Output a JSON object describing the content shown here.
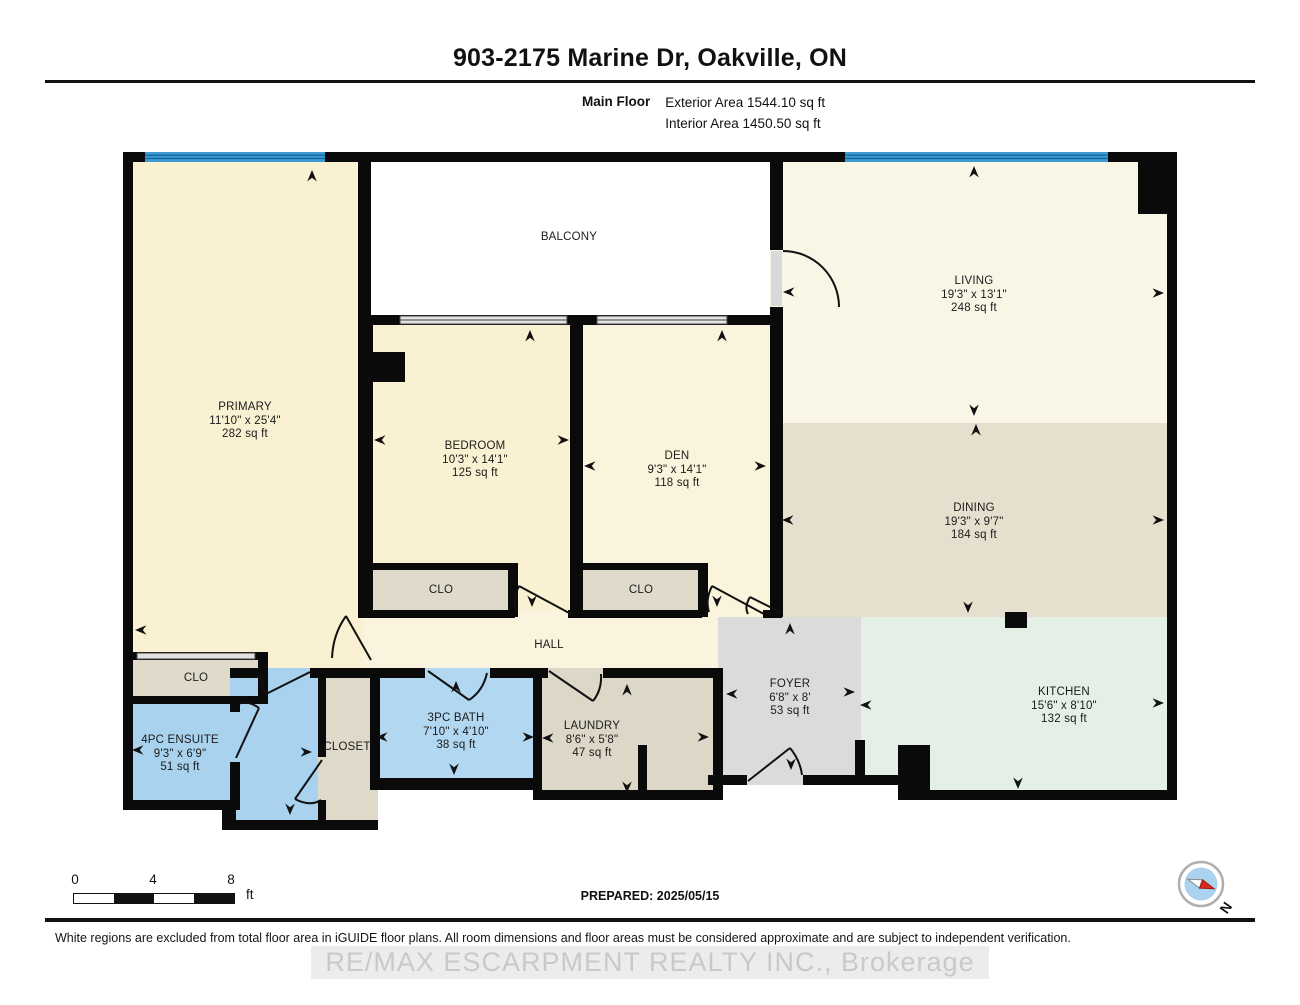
{
  "header": {
    "title": "903-2175 Marine Dr, Oakville, ON",
    "floor_label": "Main Floor",
    "exterior_area": "Exterior Area 1544.10 sq ft",
    "interior_area": "Interior Area 1450.50 sq ft"
  },
  "rooms": {
    "balcony": {
      "name": "BALCONY"
    },
    "primary": {
      "name": "PRIMARY",
      "dims": "11'10\" x 25'4\"",
      "area": "282 sq ft"
    },
    "bedroom": {
      "name": "BEDROOM",
      "dims": "10'3\" x 14'1\"",
      "area": "125 sq ft"
    },
    "den": {
      "name": "DEN",
      "dims": "9'3\" x 14'1\"",
      "area": "118 sq ft"
    },
    "living": {
      "name": "LIVING",
      "dims": "19'3\" x 13'1\"",
      "area": "248 sq ft"
    },
    "dining": {
      "name": "DINING",
      "dims": "19'3\" x 9'7\"",
      "area": "184 sq ft"
    },
    "kitchen": {
      "name": "KITCHEN",
      "dims": "15'6\" x 8'10\"",
      "area": "132 sq ft"
    },
    "foyer": {
      "name": "FOYER",
      "dims": "6'8\" x 8'",
      "area": "53 sq ft"
    },
    "hall": {
      "name": "HALL"
    },
    "laundry": {
      "name": "LAUNDRY",
      "dims": "8'6\" x 5'8\"",
      "area": "47 sq ft"
    },
    "bath": {
      "name": "3PC BATH",
      "dims": "7'10\" x 4'10\"",
      "area": "38 sq ft"
    },
    "ensuite": {
      "name": "4PC ENSUITE",
      "dims": "9'3\" x 6'9\"",
      "area": "51 sq ft"
    },
    "closet": {
      "name": "CLOSET"
    },
    "clo_primary": {
      "name": "CLO"
    },
    "clo_bedroom": {
      "name": "CLO"
    },
    "clo_den": {
      "name": "CLO"
    }
  },
  "scale_bar": {
    "tick_0": "0",
    "tick_4": "4",
    "tick_8": "8",
    "unit": "ft"
  },
  "compass": {
    "north_label": "N"
  },
  "footer": {
    "prepared": "PREPARED: 2025/05/15",
    "disclaimer": "White regions are excluded from total floor area in iGUIDE floor plans. All room dimensions and floor areas must be considered approximate and are subject to independent verification.",
    "watermark": "RE/MAX ESCARPMENT REALTY INC., Brokerage"
  },
  "colors": {
    "wall": "#0a0a0a",
    "window_blue": "#3d9bd2",
    "room_cream": "#faf0d2",
    "den_cream": "#fbf4dc",
    "living_cream": "#faf6e6",
    "dining_tan": "#e6dfcd",
    "kitchen_mint": "#e4efe6",
    "foyer_gray": "#dbdbdb",
    "bath_blue": "#a9d2ee",
    "closet_tan": "#ded9c8"
  }
}
